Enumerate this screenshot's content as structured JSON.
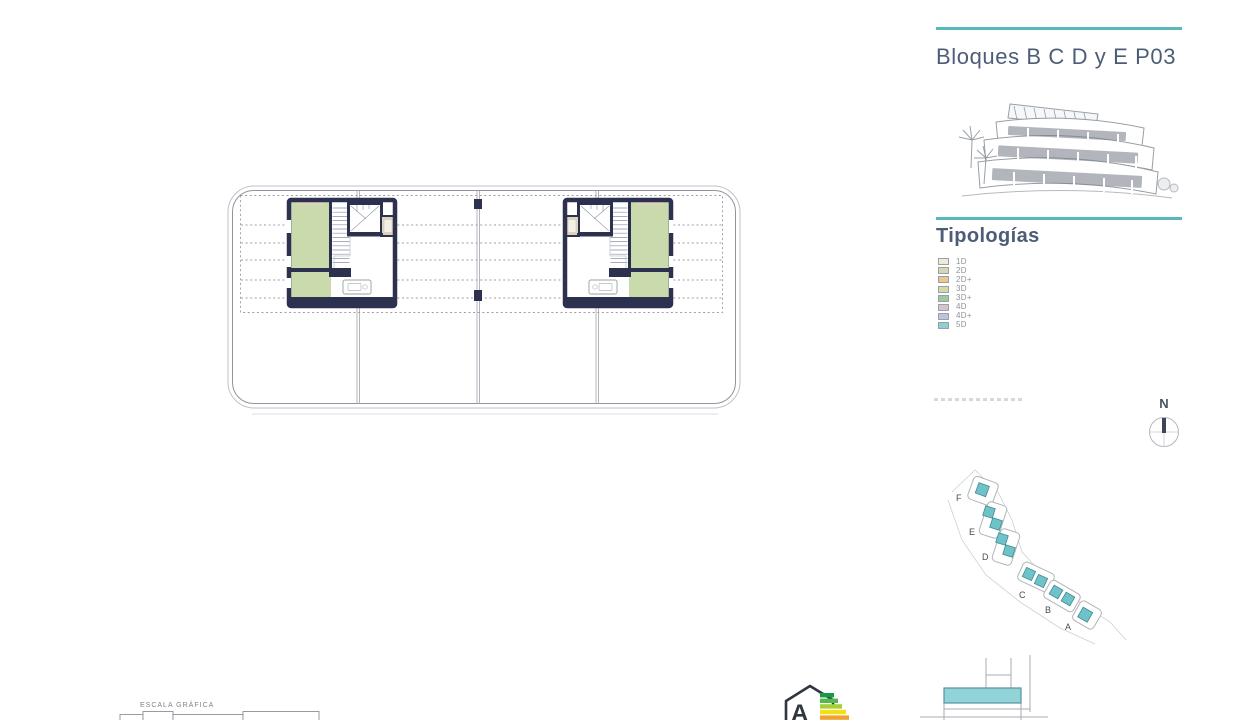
{
  "sheet": {
    "background": "#ffffff"
  },
  "header": {
    "title": "Bloques B C D y E P03",
    "accent_color": "#57b9bd",
    "text_color": "#4e5d77"
  },
  "typologies": {
    "heading": "Tipologías",
    "items": [
      {
        "label": "1D",
        "color": "#f0ebd9"
      },
      {
        "label": "2D",
        "color": "#d8d4b8"
      },
      {
        "label": "2D+",
        "color": "#ecc690"
      },
      {
        "label": "3D",
        "color": "#d6d9a6"
      },
      {
        "label": "3D+",
        "color": "#9cc8a2"
      },
      {
        "label": "4D",
        "color": "#d6c3ce"
      },
      {
        "label": "4D+",
        "color": "#bdc4dc"
      },
      {
        "label": "5D",
        "color": "#8bd1d3"
      }
    ]
  },
  "floor_plan": {
    "wall_color": "#2c3150",
    "unit_room_color": "#c9dbad",
    "elevator_color": "#ddd3bb",
    "outline_color": "#9fa3aa"
  },
  "compass": {
    "label": "N"
  },
  "site_plan": {
    "block_labels": [
      "F",
      "E",
      "D",
      "C",
      "B",
      "A"
    ],
    "highlight_color": "#6fc2c8"
  },
  "scale_bar": {
    "label": "ESCALA GRÁFICA"
  },
  "energy_label": {
    "letter": "A",
    "bar_colors": [
      "#169b4e",
      "#54b948",
      "#a5ce39",
      "#f4e019",
      "#f0a22e"
    ]
  },
  "section_diagram": {
    "highlight_color": "#92d3d8"
  }
}
